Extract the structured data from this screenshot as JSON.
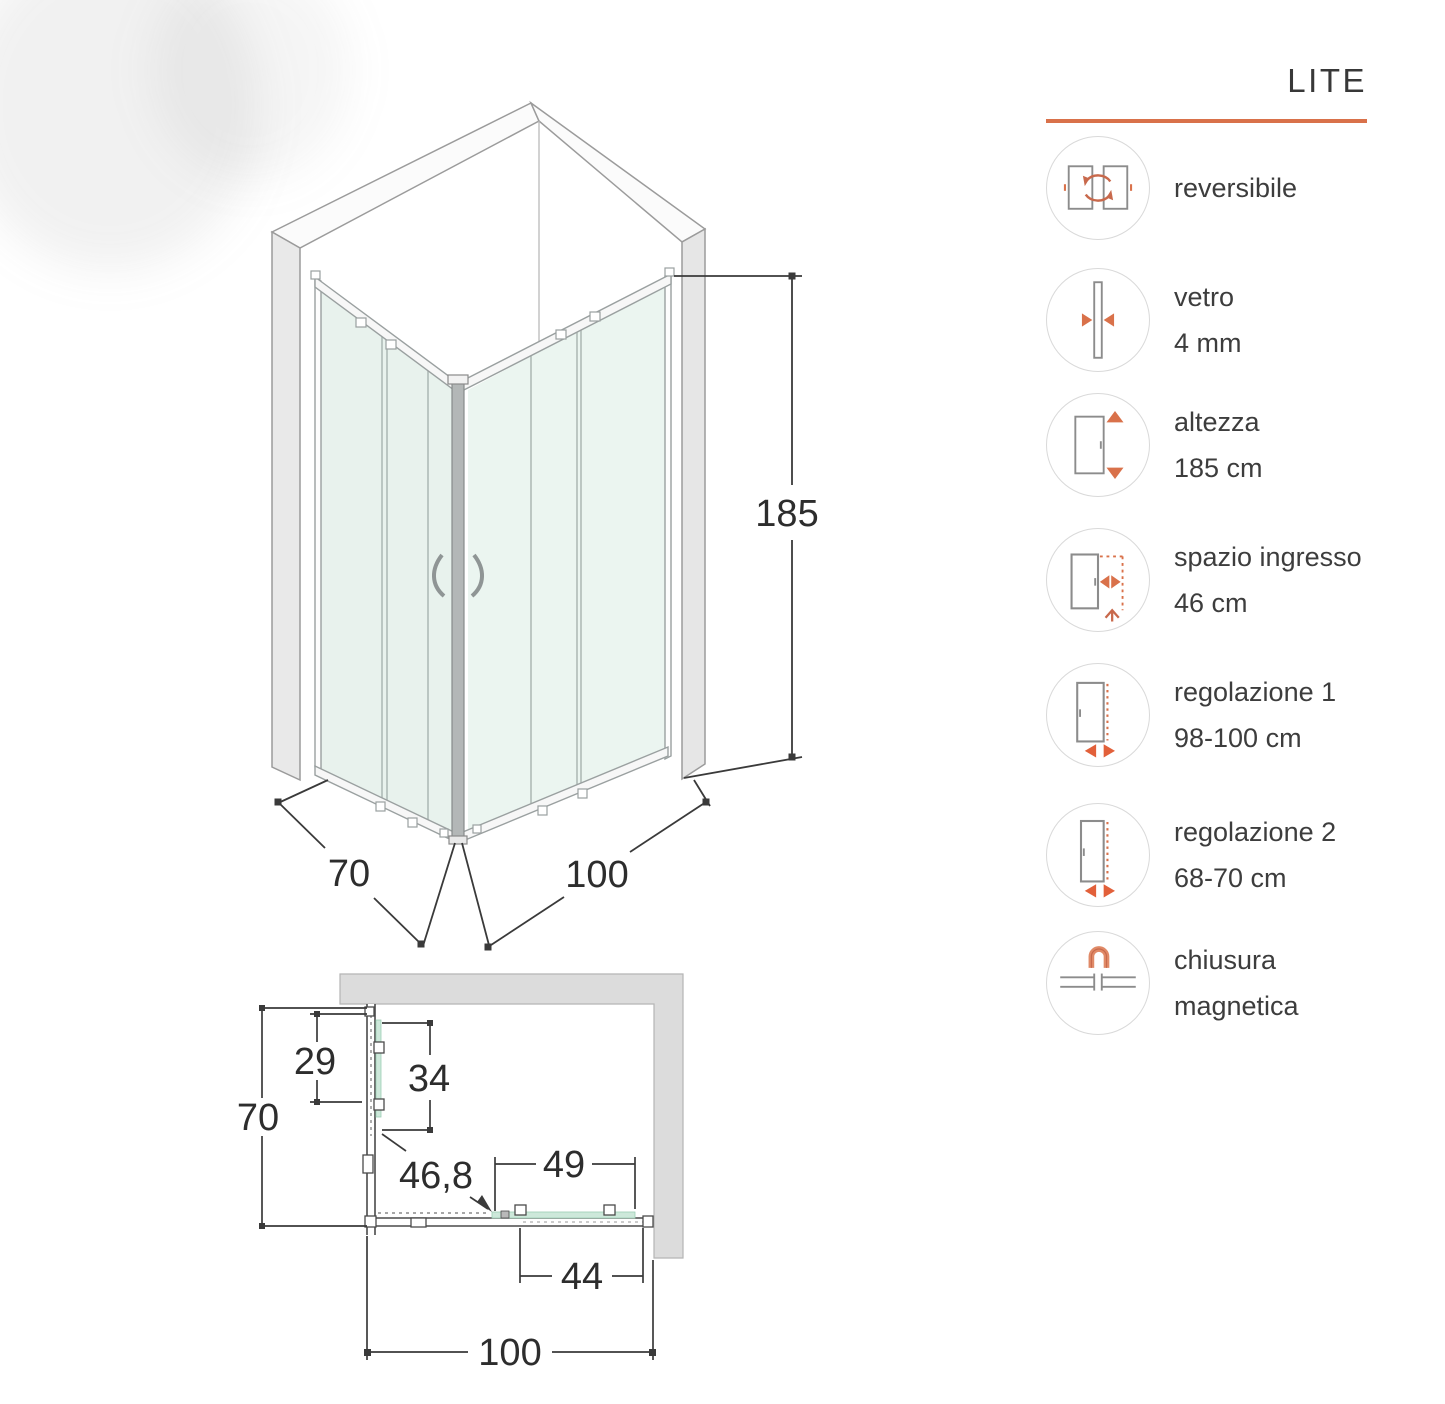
{
  "accent_color": "#d9714a",
  "iso_view": {
    "dim_height": "185",
    "dim_depth": "70",
    "dim_width": "100"
  },
  "plan_view": {
    "dim_total_depth": "70",
    "dim_upper_left": "29",
    "dim_inner_left": "34",
    "dim_diagonal": "46,8",
    "dim_door_span": "49",
    "dim_lower_right": "44",
    "dim_total_width": "100"
  },
  "sidebar": {
    "title": "LITE",
    "features": [
      {
        "icon": "reversible-doors-icon",
        "lines": [
          "reversibile",
          ""
        ]
      },
      {
        "icon": "glass-thickness-icon",
        "lines": [
          "vetro",
          "4 mm"
        ]
      },
      {
        "icon": "height-icon",
        "lines": [
          "altezza",
          "185 cm"
        ]
      },
      {
        "icon": "entry-space-icon",
        "lines": [
          "spazio ingresso",
          "46 cm"
        ]
      },
      {
        "icon": "adjustment-1-icon",
        "lines": [
          "regolazione 1",
          "98-100 cm"
        ]
      },
      {
        "icon": "adjustment-2-icon",
        "lines": [
          "regolazione 2",
          "68-70 cm"
        ]
      },
      {
        "icon": "magnetic-closure-icon",
        "lines": [
          "chiusura",
          "magnetica"
        ]
      }
    ]
  }
}
